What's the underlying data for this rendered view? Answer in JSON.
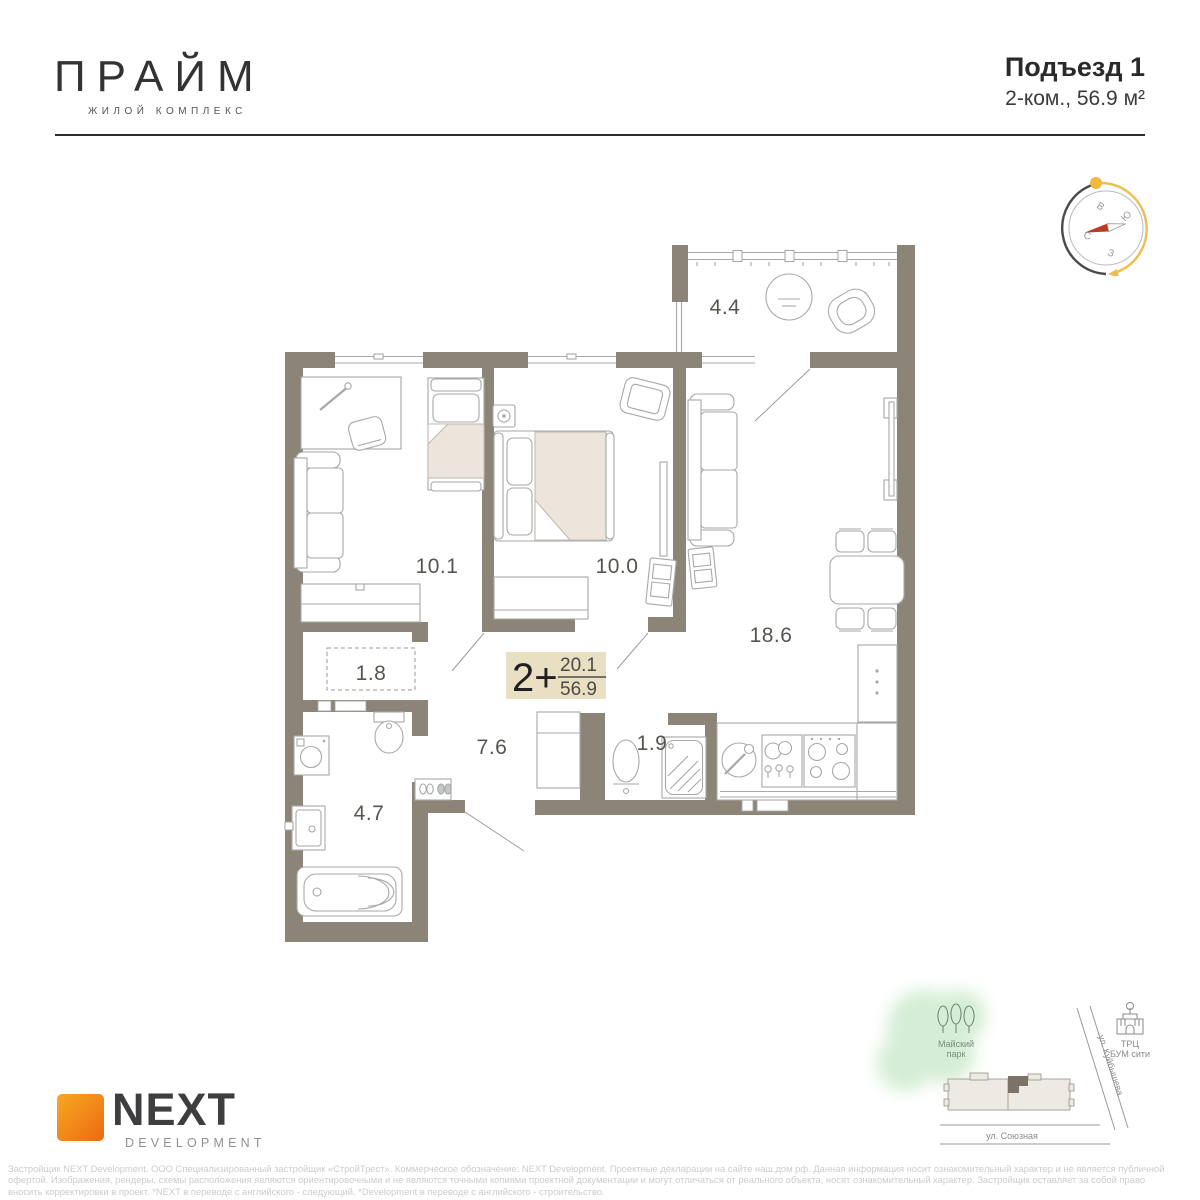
{
  "header": {
    "logo_title": "ПРАЙМ",
    "logo_subtitle": "ЖИЛОЙ КОМПЛЕКС",
    "entrance_label": "Подъезд 1",
    "apartment_summary": "2-ком., 56.9 м²"
  },
  "floor_plan": {
    "badge": {
      "rooms_type": "2+",
      "living_area": "20.1",
      "total_area": "56.9"
    },
    "room_areas": {
      "balcony": "4.4",
      "bedroom1": "10.1",
      "bedroom2": "10.0",
      "living_kitchen": "18.6",
      "wardrobe": "1.8",
      "hallway": "7.6",
      "wc": "1.9",
      "bathroom": "4.7"
    }
  },
  "compass": {
    "east": "В",
    "south": "Ю",
    "north": "С",
    "west": "З"
  },
  "minimap": {
    "park_line1": "Майский",
    "park_line2": "парк",
    "mall_line1": "ТРЦ",
    "mall_line2": "БУМ сити",
    "street_diagonal": "ул. Куйбышева",
    "street_bottom": "ул. Союзная"
  },
  "developer": {
    "name": "NEXT",
    "division": "DEVELOPMENT"
  },
  "disclaimer": {
    "lines": [
      "Застройщик NEXT Development. ООО Специализированный застройщик «СтройТрест». Коммерческое обозначение: NEXT Development. Проектные декларации на сайте наш.дом.рф. Данная информация носит ознакомительный характер и не является публичной",
      "офертой. Изображения, рендеры, схемы расположения являются ориентировочными и не являются точными копиями проектной документации и могут отличаться от реального объекта, носят ознакомительный характер. Застройщик оставляет за собой право",
      "вносить корректировки в проект. *NEXT в переводе с английского - следующий. *Development в переводе с английского - строительство."
    ]
  },
  "colors": {
    "wall": "#8C8477",
    "badge_bg": "#E9DFC3",
    "bed_fill": "#EDE5DC",
    "brand_orange_start": "#F7A823",
    "brand_orange_end": "#EC6A12",
    "compass_arc_yellow": "#EDBE4D",
    "compass_needle_red": "#BE3A28",
    "park_green": "#8FD08F"
  }
}
